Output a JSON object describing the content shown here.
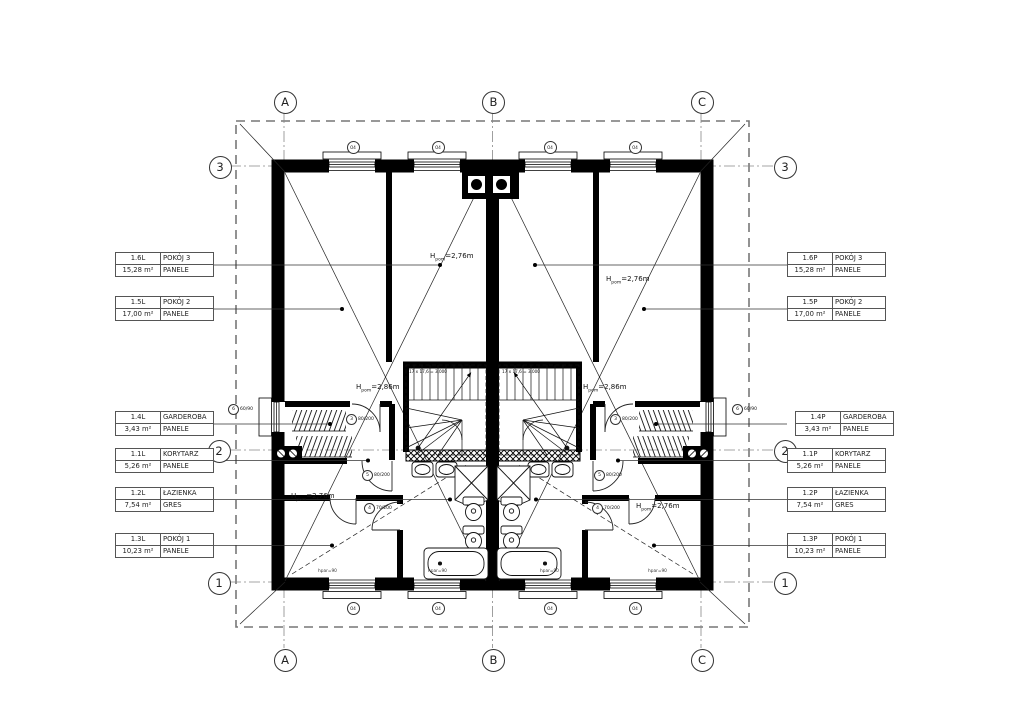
{
  "axes": {
    "a": "A",
    "b": "B",
    "c": "C",
    "n1": "1",
    "n2": "2",
    "n3": "3"
  },
  "rooms_left": [
    {
      "code": "1.6L",
      "name": "POKÓJ 3",
      "area": "15,28",
      "unit": "m²",
      "floor": "PANELE"
    },
    {
      "code": "1.5L",
      "name": "POKÓJ 2",
      "area": "17,00",
      "unit": "m²",
      "floor": "PANELE"
    },
    {
      "code": "1.4L",
      "name": "GARDEROBA",
      "area": "3,43",
      "unit": "m²",
      "floor": "PANELE"
    },
    {
      "code": "1.1L",
      "name": "KORYTARZ",
      "area": "5,26",
      "unit": "m²",
      "floor": "PANELE"
    },
    {
      "code": "1.2L",
      "name": "ŁAZIENKA",
      "area": "7,54",
      "unit": "m²",
      "floor": "GRES"
    },
    {
      "code": "1.3L",
      "name": "POKÓJ 1",
      "area": "10,23",
      "unit": "m²",
      "floor": "PANELE"
    }
  ],
  "rooms_right": [
    {
      "code": "1.6P",
      "name": "POKÓJ 3",
      "area": "15,28",
      "unit": "m²",
      "floor": "PANELE"
    },
    {
      "code": "1.5P",
      "name": "POKÓJ 2",
      "area": "17,00",
      "unit": "m²",
      "floor": "PANELE"
    },
    {
      "code": "1.4P",
      "name": "GARDEROBA",
      "area": "3,43",
      "unit": "m²",
      "floor": "PANELE"
    },
    {
      "code": "1.1P",
      "name": "KORYTARZ",
      "area": "5,26",
      "unit": "m²",
      "floor": "PANELE"
    },
    {
      "code": "1.2P",
      "name": "ŁAZIENKA",
      "area": "7,54",
      "unit": "m²",
      "floor": "GRES"
    },
    {
      "code": "1.3P",
      "name": "POKÓJ 1",
      "area": "10,23",
      "unit": "m²",
      "floor": "PANELE"
    }
  ],
  "heights": {
    "prefix": "H",
    "sub": "pom",
    "h276": "=2,76m",
    "h286": "=2,86m"
  },
  "stairs": {
    "formula": "17 x 17,6 = 3,000"
  },
  "openings": {
    "door80": "80/200",
    "door70": "70/200",
    "win60": "60/90",
    "mark": "O4",
    "n3": "3",
    "n4": "4",
    "n5": "5",
    "n6": "6",
    "hpar": "hpar=90"
  }
}
